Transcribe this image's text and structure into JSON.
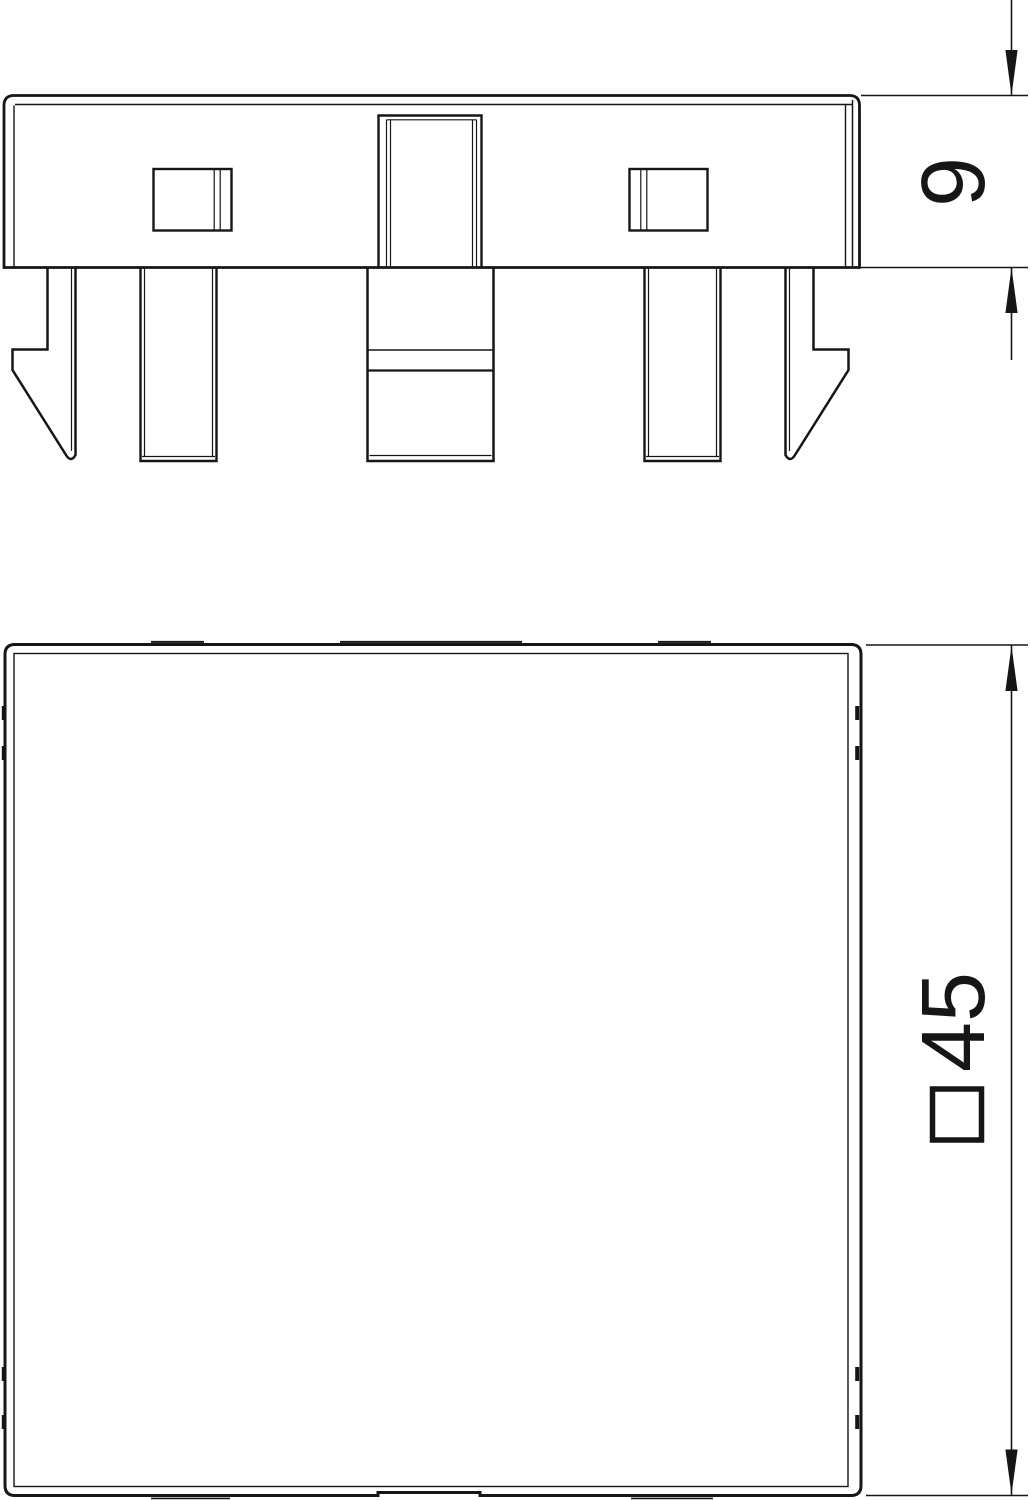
{
  "drawing": {
    "background_color": "#ffffff",
    "line_color": "#161616",
    "side_view": {
      "description": "side profile of mounting plate with snap-in clips",
      "height_dimension": {
        "value": "9"
      }
    },
    "front_view": {
      "description": "square front face of cover plate",
      "width_dimension": {
        "value": "45",
        "symbol": "□",
        "full_label": "□45"
      }
    }
  }
}
